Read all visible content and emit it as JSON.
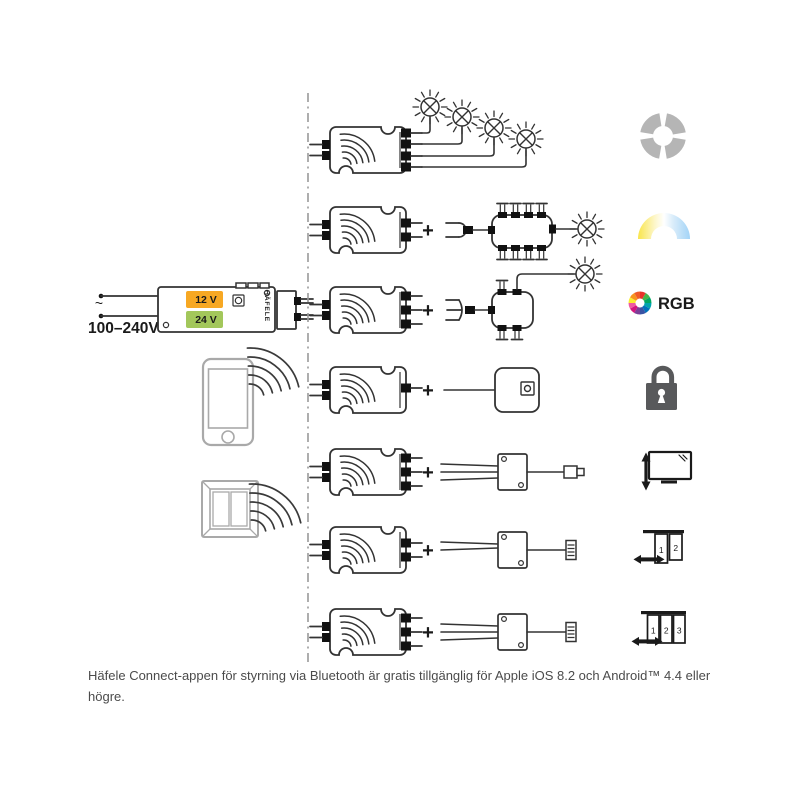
{
  "psu": {
    "input_label": "100–240V",
    "ac_symbol": "~",
    "output_12v": "12 V",
    "output_24v": "24 V",
    "brand": "HÄFELE"
  },
  "plus": "+",
  "icons": {
    "rgb_label": "RGB",
    "doors2": [
      "1",
      "2"
    ],
    "doors3": [
      "1",
      "2",
      "3"
    ],
    "names": [
      "dimming-quadrant-icon",
      "tunable-white-icon",
      "rgb-wheel-icon",
      "padlock-icon",
      "tv-lift-icon",
      "sliding-door-2-icon",
      "sliding-door-3-icon",
      "wireless-signal-icon",
      "lamp-icon",
      "smartphone-icon",
      "wall-switch-icon"
    ]
  },
  "colors": {
    "badge_12v_orange": "#F7A823",
    "badge_24v_green": "#A3C75B",
    "icon_gray": "#B5B5B5",
    "lock_gray": "#58595B",
    "tunable_white": [
      "#F9E54C",
      "#FDF6C9",
      "#FFFFFF",
      "#D9ECFA",
      "#A3D4F7"
    ],
    "rgb_wheel": [
      "#E8332A",
      "#46B549",
      "#00A862",
      "#00A4AD",
      "#0072BB",
      "#3953A4",
      "#7A3F98",
      "#D4157E",
      "#EF5AA1",
      "#F9ED33",
      "#F7941D",
      "#F05A28"
    ]
  },
  "caption": [
    "Häfele Connect-appen för styrning via Bluetooth är gratis tillgänglig för Apple iOS 8.2 och Android™ 4.4 eller",
    "högre."
  ]
}
